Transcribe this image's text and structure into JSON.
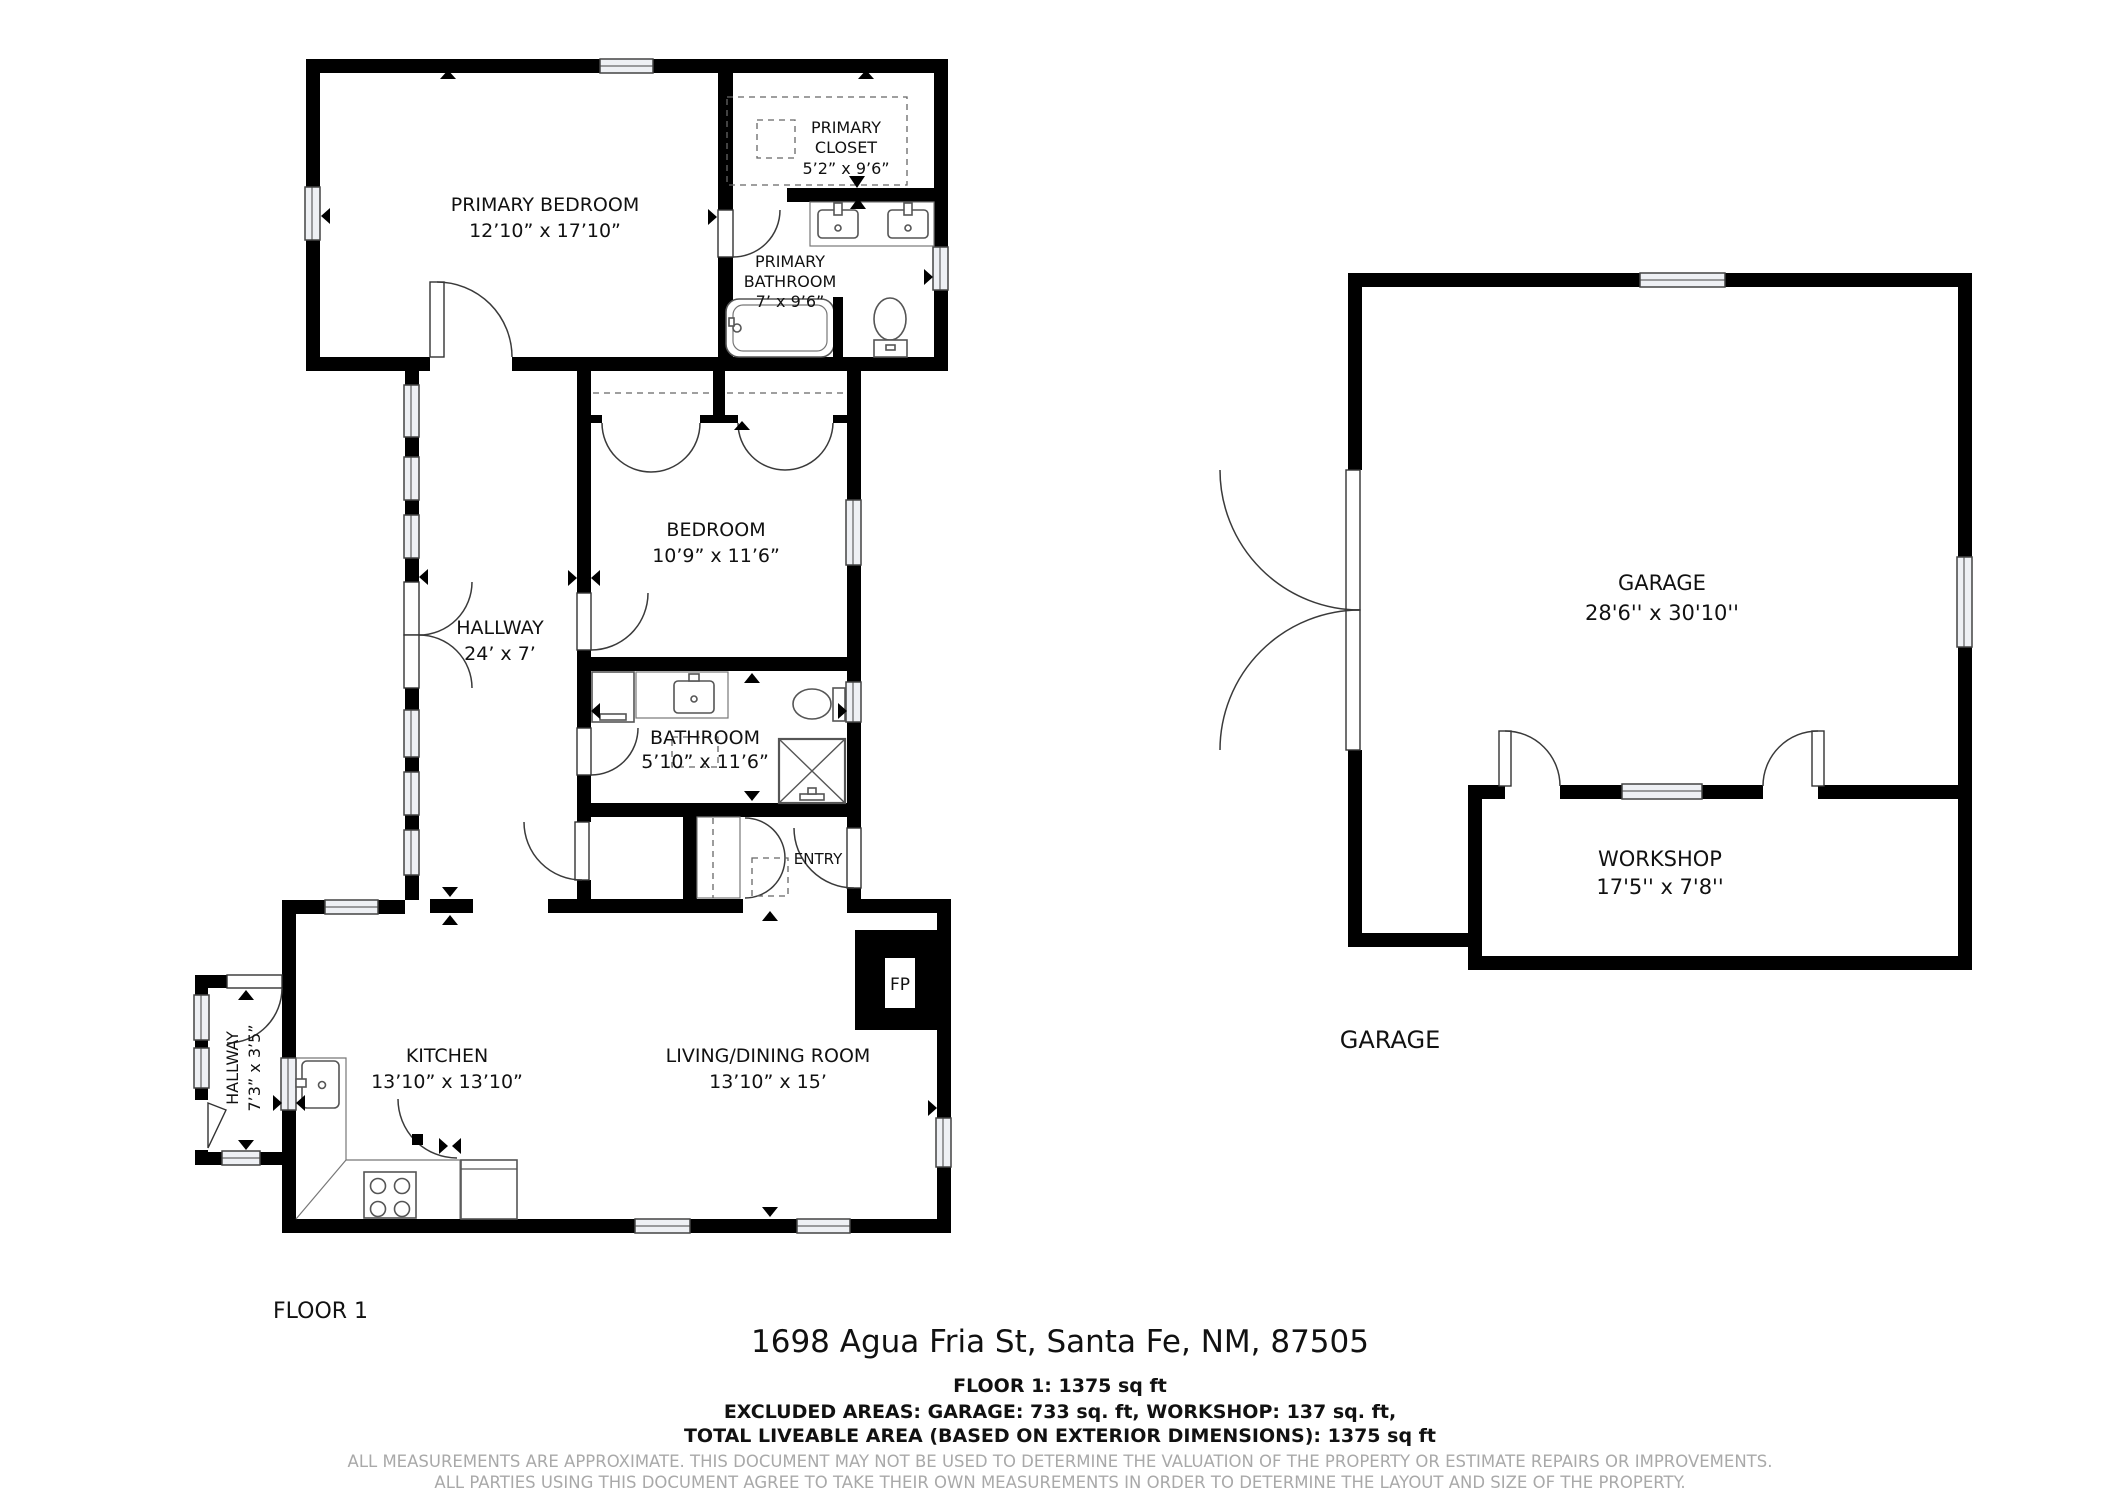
{
  "rooms": {
    "primary_bedroom": {
      "name": "PRIMARY BEDROOM",
      "dims": "12’10” x 17’10”"
    },
    "primary_closet": {
      "line1": "PRIMARY",
      "line2": "CLOSET",
      "dims": "5’2” x 9’6”"
    },
    "primary_bathroom": {
      "line1": "PRIMARY",
      "line2": "BATHROOM",
      "dims": "7’ x 9’6”"
    },
    "bedroom": {
      "name": "BEDROOM",
      "dims": "10’9” x 11’6”"
    },
    "hallway": {
      "name": "HALLWAY",
      "dims": "24’ x 7’"
    },
    "bathroom": {
      "name": "BATHROOM",
      "dims": "5’10” x 11’6”"
    },
    "entry": {
      "name": "ENTRY"
    },
    "kitchen": {
      "name": "KITCHEN",
      "dims": "13’10” x 13’10”"
    },
    "living": {
      "name": "LIVING/DINING ROOM",
      "dims": "13’10” x 15’"
    },
    "hallway_small": {
      "name": "HALLWAY",
      "dims": "7’3” x 3’5”"
    },
    "garage": {
      "name": "GARAGE",
      "dims": "28'6'' x 30'10''"
    },
    "workshop": {
      "name": "WORKSHOP",
      "dims": "17'5'' x 7'8''"
    },
    "fireplace": {
      "abbr": "FP"
    }
  },
  "captions": {
    "floor": "FLOOR 1",
    "garage": "GARAGE"
  },
  "footer": {
    "address": "1698 Agua Fria St, Santa Fe, NM, 87505",
    "floor_area": "FLOOR 1: 1375 sq ft",
    "excluded": "EXCLUDED AREAS: GARAGE: 733 sq. ft, WORKSHOP: 137 sq. ft,",
    "total": "TOTAL LIVEABLE AREA (BASED ON EXTERIOR DIMENSIONS): 1375 sq ft",
    "disclaimer1": "ALL MEASUREMENTS ARE APPROXIMATE. THIS DOCUMENT MAY NOT BE USED TO DETERMINE THE VALUATION OF THE PROPERTY OR ESTIMATE REPAIRS OR IMPROVEMENTS.",
    "disclaimer2": "ALL PARTIES USING THIS DOCUMENT AGREE TO TAKE THEIR OWN MEASUREMENTS IN ORDER TO DETERMINE THE LAYOUT AND SIZE OF THE PROPERTY."
  }
}
